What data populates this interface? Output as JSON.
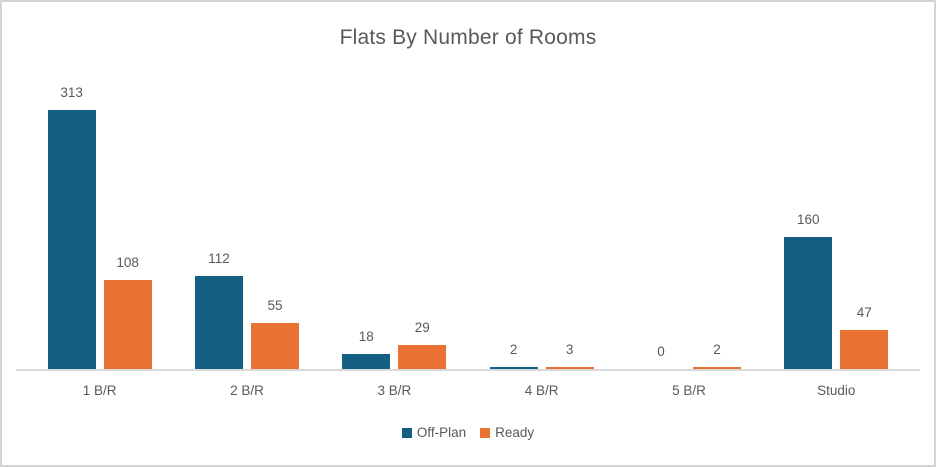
{
  "chart_data": {
    "type": "bar",
    "title": "Flats By Number of Rooms",
    "categories": [
      "1 B/R",
      "2 B/R",
      "3 B/R",
      "4 B/R",
      "5 B/R",
      "Studio"
    ],
    "series": [
      {
        "name": "Off-Plan",
        "color": "#156082",
        "values": [
          313,
          112,
          18,
          2,
          0,
          160
        ]
      },
      {
        "name": "Ready",
        "color": "#E97132",
        "values": [
          108,
          55,
          29,
          3,
          2,
          47
        ]
      }
    ],
    "ylim": [
      0,
      350
    ],
    "grid": false,
    "data_labels": true,
    "legend_position": "bottom",
    "xlabel": "",
    "ylabel": ""
  },
  "colors": {
    "title_text": "#595959",
    "label_text": "#595959",
    "axis_line": "#d9d9d9",
    "frame_border": "#d5d3d3"
  }
}
